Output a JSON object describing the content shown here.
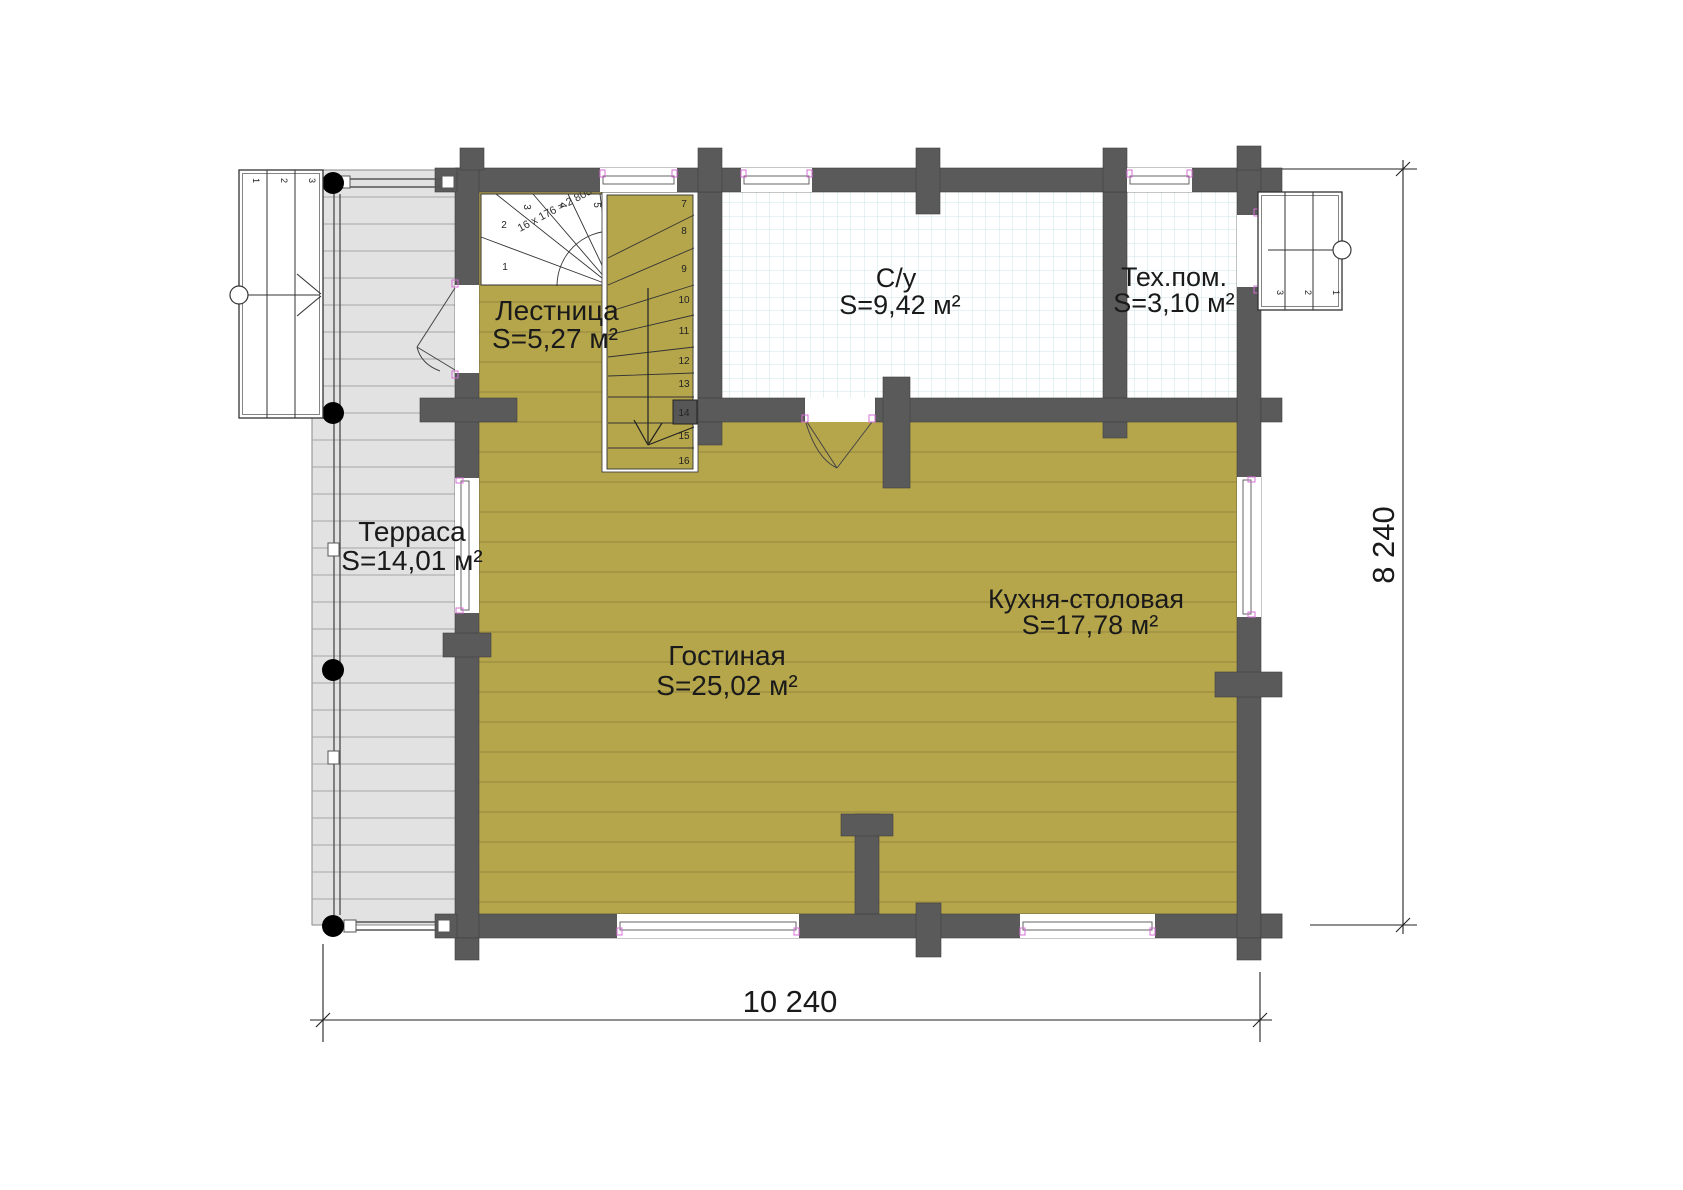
{
  "plan": {
    "rooms": [
      {
        "name": "Терраса",
        "area": "S=14,01 м²"
      },
      {
        "name": "Лестница",
        "area": "S=5,27 м²"
      },
      {
        "name": "С/у",
        "area": "S=9,42 м²"
      },
      {
        "name": "Тех.пом.",
        "area": "S=3,10 м²"
      },
      {
        "name": "Гостиная",
        "area": "S=25,02 м²"
      },
      {
        "name": "Кухня-столовая",
        "area": "S=17,78 м²"
      }
    ],
    "dimensions": {
      "bottom": "10 240",
      "right": "8 240"
    },
    "stairs": {
      "formula": "16 x 176 = 2 808",
      "winder": [
        "1",
        "2",
        "3",
        "4",
        "5",
        "6"
      ],
      "flight": [
        "7",
        "8",
        "9",
        "10",
        "11",
        "12",
        "13",
        "14",
        "15",
        "16"
      ],
      "left_entry": [
        "1",
        "2",
        "3"
      ],
      "right_entry": [
        "3",
        "2",
        "1"
      ]
    },
    "colors": {
      "wall": "#5a5a5a",
      "floor": "#b5a64c",
      "floor_line": "#958640",
      "terrace": "#e2e2e2",
      "tile_line": "#cbe6e9",
      "frame_mark": "#d76fd7"
    }
  }
}
